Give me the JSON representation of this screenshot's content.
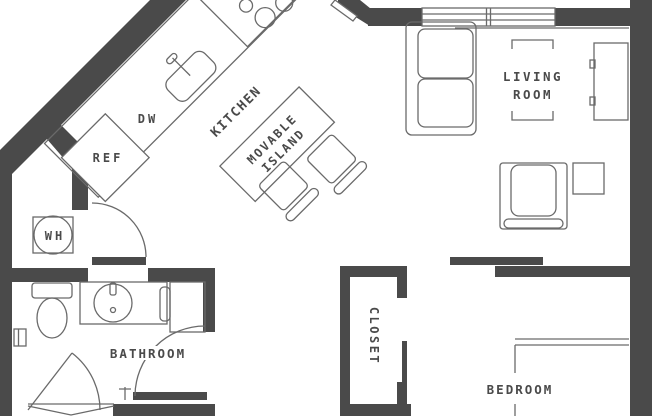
{
  "floor_plan": {
    "rooms": {
      "kitchen": {
        "label": "KITCHEN"
      },
      "living_room": {
        "label_line1": "LIVING",
        "label_line2": "ROOM"
      },
      "bedroom": {
        "label": "BEDROOM"
      },
      "bathroom": {
        "label": "BATHROOM"
      },
      "closet": {
        "label": "CLOSET"
      }
    },
    "fixtures": {
      "island": {
        "label_line1": "MOVABLE",
        "label_line2": "ISLAND"
      },
      "refrigerator": {
        "label": "REF"
      },
      "dishwasher": {
        "label": "DW"
      },
      "water_heater": {
        "label": "WH"
      }
    },
    "colors": {
      "wall": "#4a4a4a",
      "line": "#6a6a6a",
      "text": "#4a4a4a",
      "background": "#ffffff"
    }
  }
}
